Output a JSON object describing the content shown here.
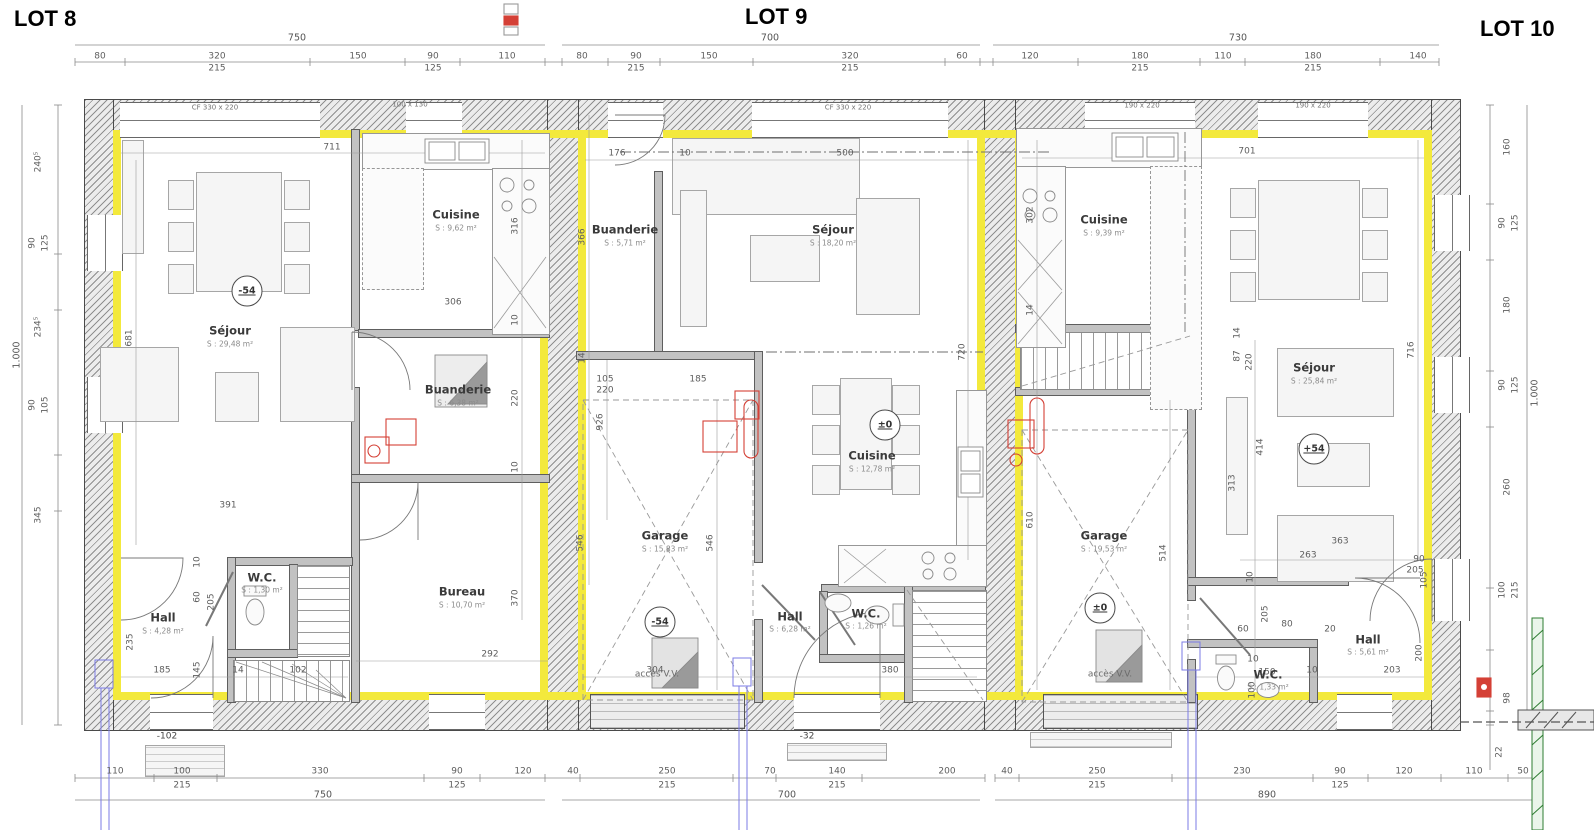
{
  "titles": {
    "lot8": "LOT 8",
    "lot9": "LOT 9",
    "lot10": "LOT 10"
  },
  "levels": {
    "lot8_sejour": "-54",
    "lot9_cuisine": "±0",
    "lot9_garage": "-54",
    "lot10_garage": "±0",
    "lot10_sejour": "+54"
  },
  "thresholds": {
    "lot8": "-102",
    "lot9": "-32"
  },
  "access_label": "accès V.V.",
  "window_labels": {
    "w1": "CF 330 x 220",
    "w2": "100 x 130",
    "w3": "CF 330 x 220",
    "w4": "190 x 220",
    "w5": "190 x 220"
  },
  "rooms": {
    "lot8_sejour": {
      "name": "Séjour",
      "area": "S : 29,48 m²"
    },
    "lot8_cuisine": {
      "name": "Cuisine",
      "area": "S : 9,62 m²"
    },
    "lot8_buanderie": {
      "name": "Buanderie",
      "area": "S : 6,38 m²"
    },
    "lot8_bureau": {
      "name": "Bureau",
      "area": "S : 10,70 m²"
    },
    "lot8_wc": {
      "name": "W.C.",
      "area": "S : 1,30 m²"
    },
    "lot8_hall": {
      "name": "Hall",
      "area": "S : 4,28 m²"
    },
    "lot9_buanderie": {
      "name": "Buanderie",
      "area": "S : 5,71 m²"
    },
    "lot9_sejour": {
      "name": "Séjour",
      "area": "S : 18,20 m²"
    },
    "lot9_garage": {
      "name": "Garage",
      "area": "S : 15,83 m²"
    },
    "lot9_cuisine": {
      "name": "Cuisine",
      "area": "S : 12,78 m²"
    },
    "lot9_hall": {
      "name": "Hall",
      "area": "S : 6,28 m²"
    },
    "lot9_wc": {
      "name": "W.C.",
      "area": "S : 1,26 m²"
    },
    "lot10_cuisine": {
      "name": "Cuisine",
      "area": "S : 9,39 m²"
    },
    "lot10_sejour": {
      "name": "Séjour",
      "area": "S : 25,84 m²"
    },
    "lot10_garage": {
      "name": "Garage",
      "area": "S : 19,53 m²"
    },
    "lot10_hall": {
      "name": "Hall",
      "area": "S : 5,61 m²"
    },
    "lot10_wc": {
      "name": "W.C.",
      "area": "S : 1,33 m²"
    }
  },
  "dims": {
    "top8": [
      "750",
      "80",
      "320",
      "215",
      "150",
      "90",
      "125",
      "110"
    ],
    "top9": [
      "700",
      "80",
      "90",
      "215",
      "150",
      "320",
      "215",
      "60"
    ],
    "top10": [
      "730",
      "120",
      "180",
      "215",
      "110",
      "180",
      "215",
      "140"
    ],
    "left": [
      "1.000",
      "240⁵",
      "90",
      "125",
      "234⁵",
      "90",
      "105",
      "345"
    ],
    "right": [
      "160",
      "90",
      "125",
      "180",
      "90",
      "125",
      "1.000",
      "260",
      "100",
      "215",
      "98",
      "22"
    ],
    "bottom8": [
      "110",
      "100",
      "215",
      "330",
      "90",
      "125",
      "120",
      "40",
      "750"
    ],
    "bottom9": [
      "250",
      "215",
      "70",
      "140",
      "215",
      "200",
      "40",
      "700"
    ],
    "bottom10": [
      "250",
      "215",
      "230",
      "90",
      "125",
      "120",
      "110",
      "50",
      "890"
    ],
    "lot8": [
      "711",
      "681",
      "306",
      "316",
      "10",
      "220",
      "10",
      "370",
      "391",
      "235",
      "185",
      "145",
      "205",
      "60",
      "10",
      "14",
      "102",
      "292"
    ],
    "lot9": [
      "176",
      "10",
      "500",
      "366",
      "14",
      "105",
      "220",
      "926",
      "185",
      "546",
      "546",
      "720",
      "304",
      "380"
    ],
    "lot10": [
      "701",
      "302",
      "14",
      "14",
      "87",
      "220",
      "716",
      "414",
      "313",
      "610",
      "514",
      "363",
      "263",
      "10",
      "90",
      "205",
      "105",
      "60",
      "80",
      "205",
      "10",
      "150",
      "100",
      "20",
      "10",
      "203",
      "200"
    ]
  },
  "colors": {
    "insulation": "#f3e93c",
    "red_accent": "#d44036",
    "blue_accent": "#7b7be6",
    "green_accent": "#2e7d32"
  }
}
